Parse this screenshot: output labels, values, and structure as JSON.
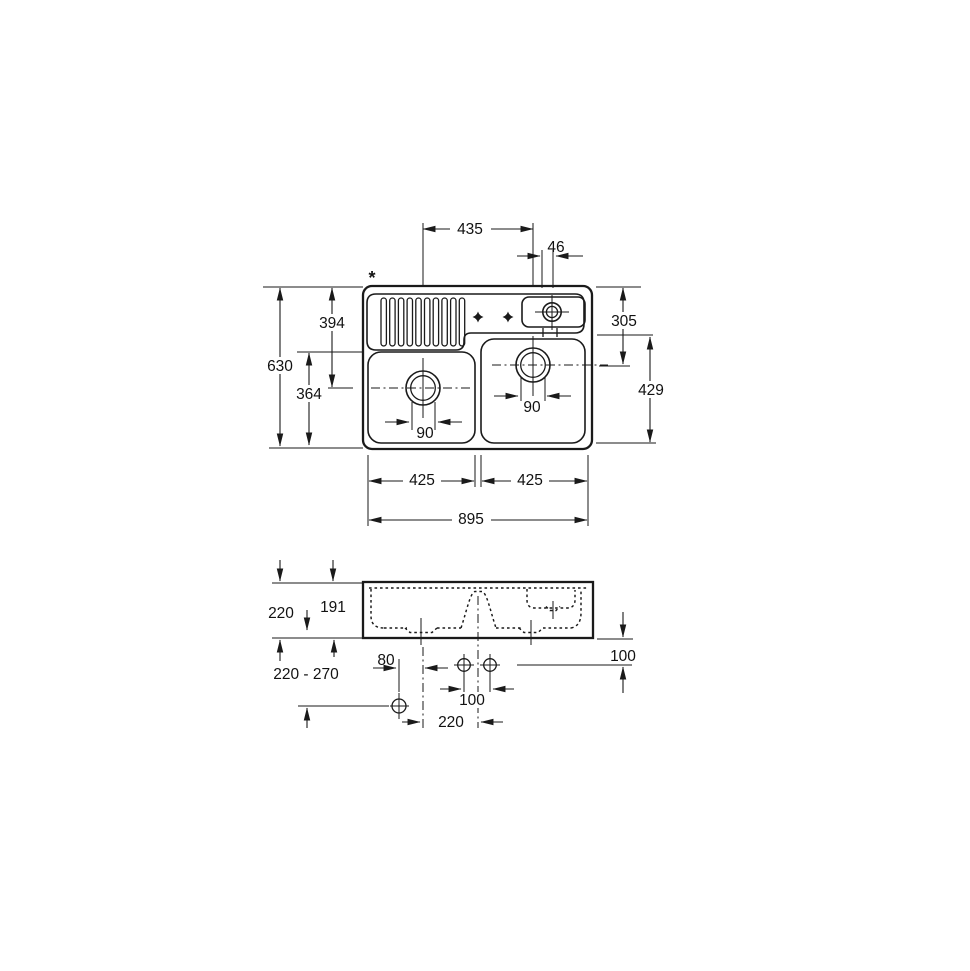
{
  "drawing": {
    "background": "#ffffff",
    "ink": "#1a1a1a",
    "footnote_marker": "*",
    "plan_view": {
      "dim_drain_centers": "435",
      "dim_tap_hole_offset": "46",
      "dim_overall_depth": "630",
      "dim_left_drain_from_back": "394",
      "dim_left_bowl_front": "364",
      "dim_right_drain_from_back": "305",
      "dim_right_bowl_depth": "429",
      "dim_left_drain": "90",
      "dim_right_drain": "90",
      "dim_left_bowl_width": "425",
      "dim_right_bowl_width": "425",
      "dim_overall_width": "895"
    },
    "section_view": {
      "dim_height": "220",
      "dim_bowl_depth": "191",
      "dim_outlet_range": "220 - 270",
      "dim_waste_offset": "80",
      "dim_tap_spacing": "100",
      "dim_tap_drop": "100",
      "dim_waste_spacing": "220"
    }
  }
}
